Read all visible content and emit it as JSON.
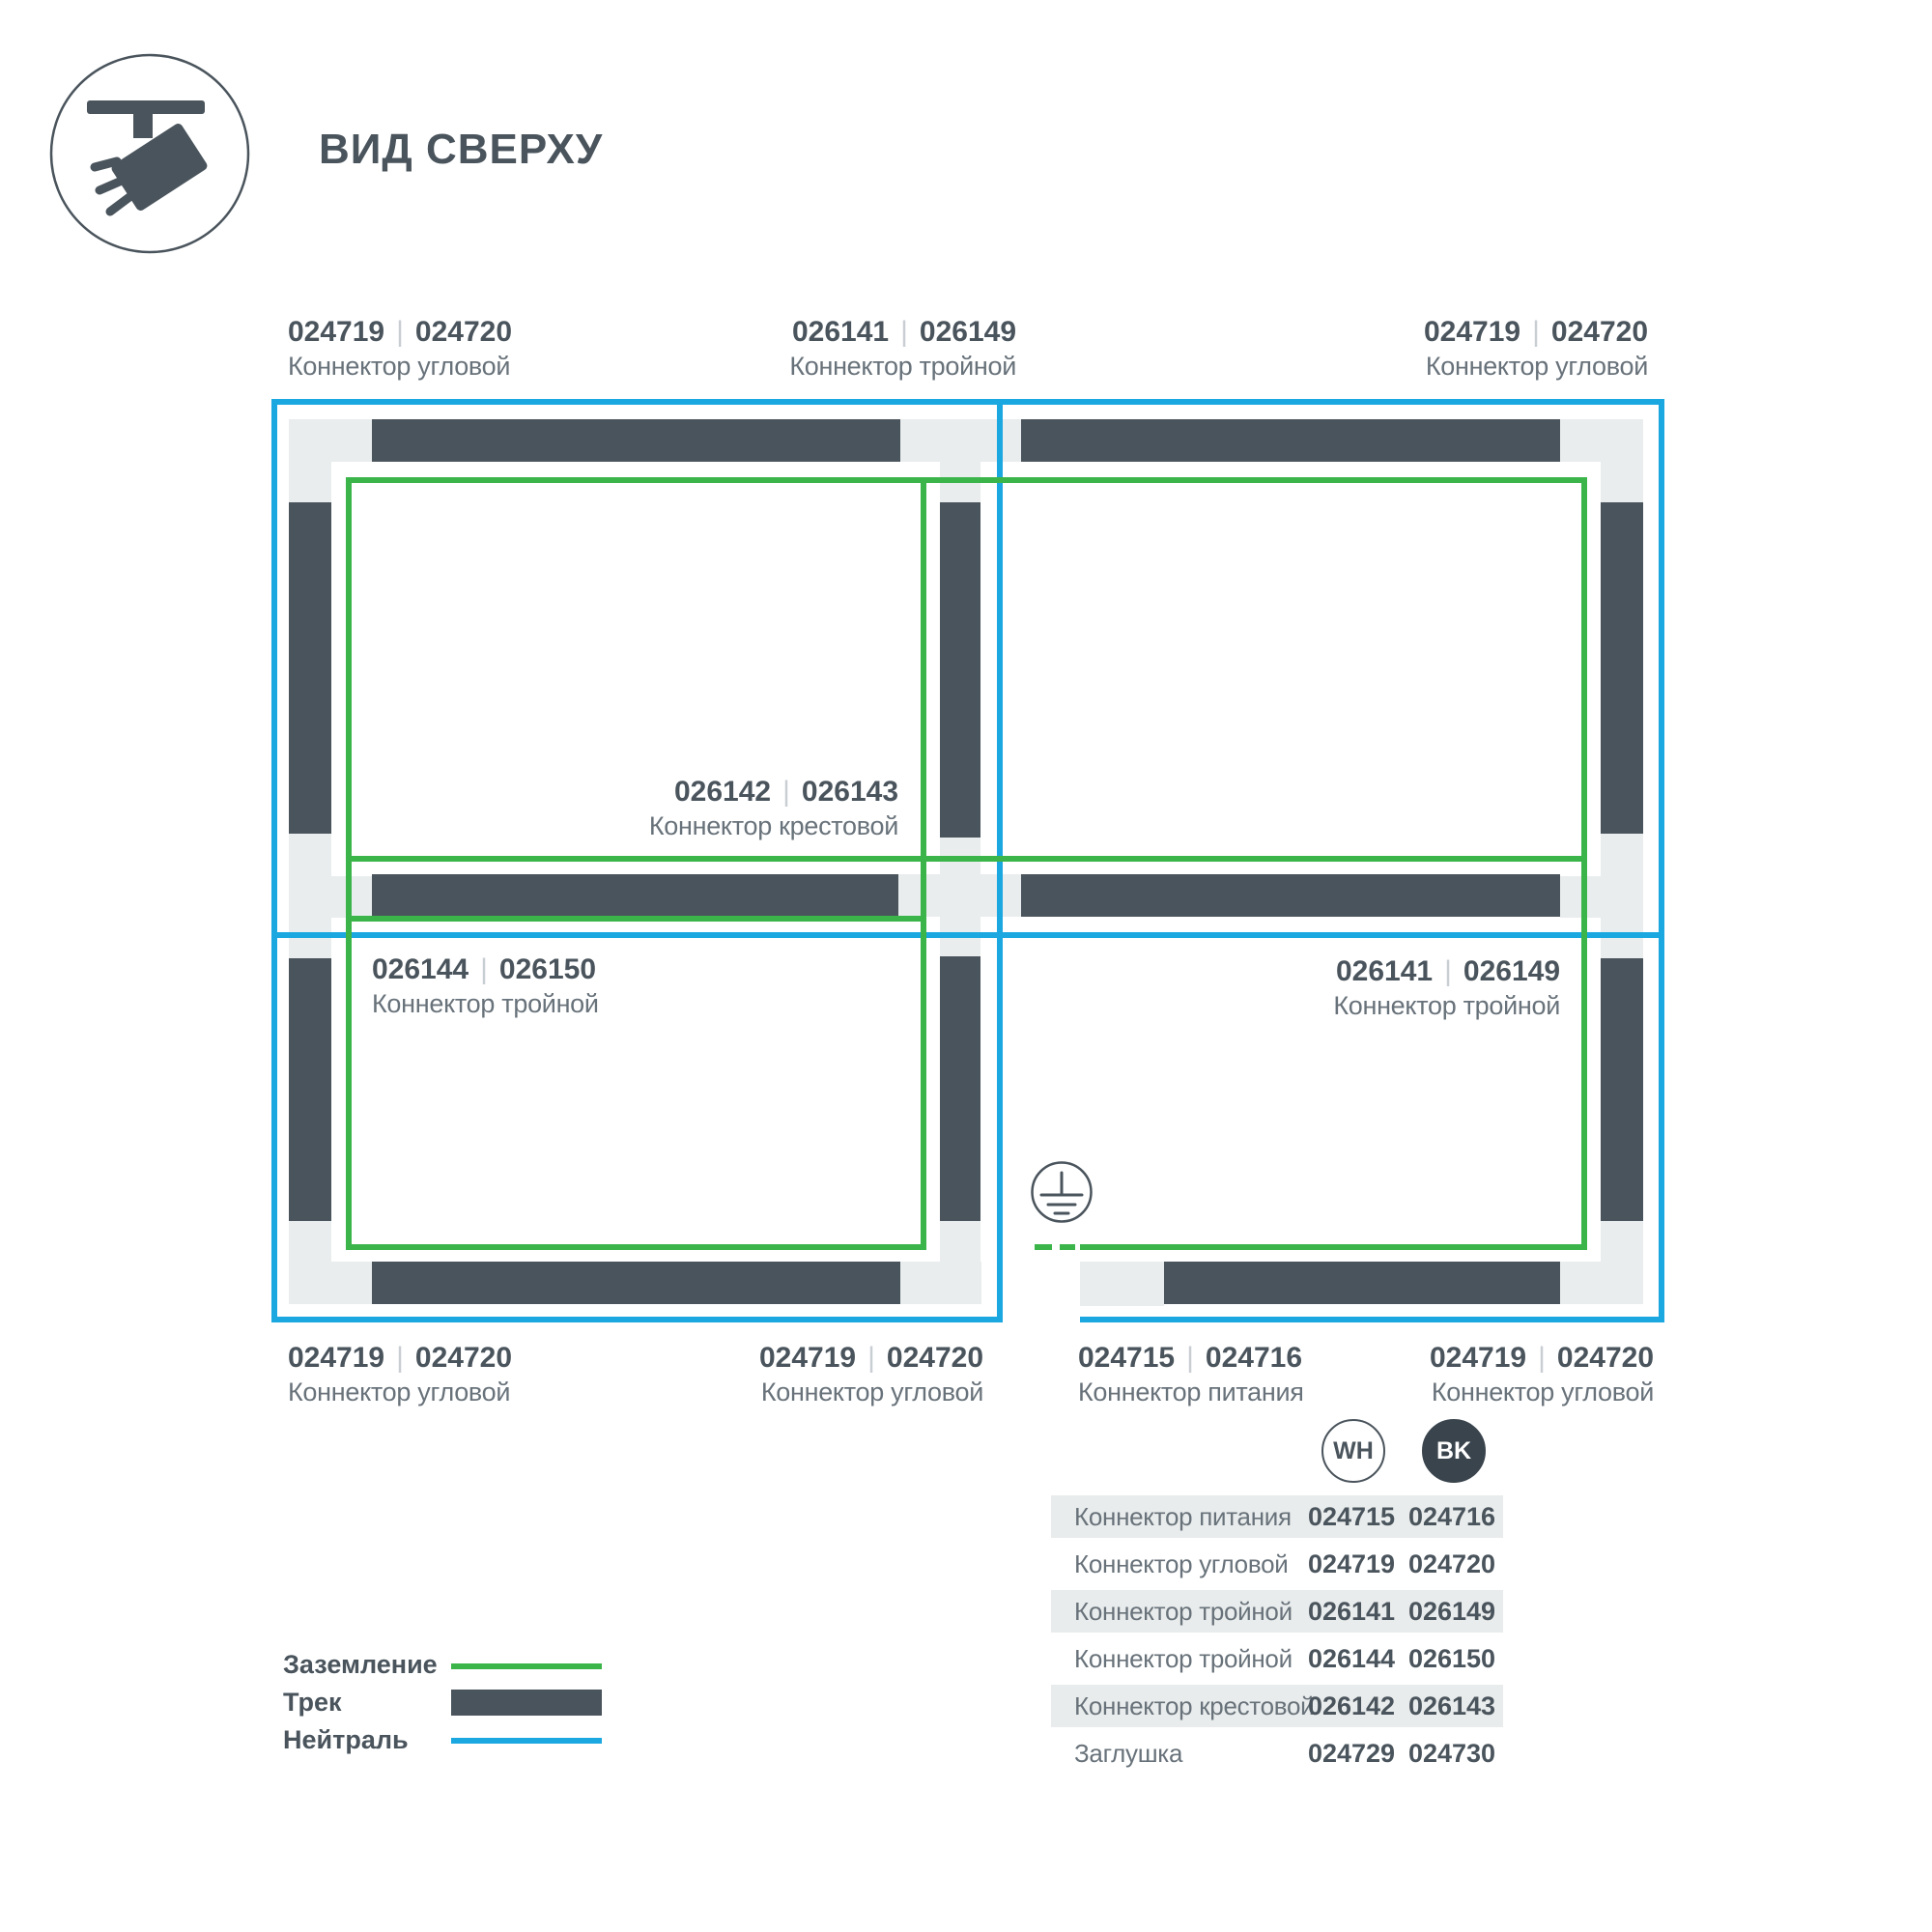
{
  "header": {
    "title": "ВИД СВЕРХУ",
    "icon": "track-spotlight-top-view-icon"
  },
  "ui": {
    "separator": "|"
  },
  "callouts": {
    "top_left": {
      "code_wh": "024719",
      "code_bk": "024720",
      "name": "Коннектор угловой"
    },
    "top_middle": {
      "code_wh": "026141",
      "code_bk": "026149",
      "name": "Коннектор тройной"
    },
    "top_right": {
      "code_wh": "024719",
      "code_bk": "024720",
      "name": "Коннектор угловой"
    },
    "cross": {
      "code_wh": "026142",
      "code_bk": "026143",
      "name": "Коннектор крестовой"
    },
    "mid_left": {
      "code_wh": "026144",
      "code_bk": "026150",
      "name": "Коннектор тройной"
    },
    "mid_right": {
      "code_wh": "026141",
      "code_bk": "026149",
      "name": "Коннектор тройной"
    },
    "bottom_1": {
      "code_wh": "024719",
      "code_bk": "024720",
      "name": "Коннектор угловой"
    },
    "bottom_2": {
      "code_wh": "024719",
      "code_bk": "024720",
      "name": "Коннектор угловой"
    },
    "bottom_3": {
      "code_wh": "024715",
      "code_bk": "024716",
      "name": "Коннектор питания"
    },
    "bottom_4": {
      "code_wh": "024719",
      "code_bk": "024720",
      "name": "Коннектор угловой"
    }
  },
  "legend": {
    "ground_label": "Заземление",
    "track_label": "Трек",
    "neutral_label": "Нейтраль"
  },
  "color_columns": {
    "wh": "WH",
    "bk": "BK"
  },
  "table": {
    "rows": [
      {
        "name": "Коннектор питания",
        "wh": "024715",
        "bk": "024716"
      },
      {
        "name": "Коннектор угловой",
        "wh": "024719",
        "bk": "024720"
      },
      {
        "name": "Коннектор тройной",
        "wh": "026141",
        "bk": "026149"
      },
      {
        "name": "Коннектор тройной",
        "wh": "026144",
        "bk": "026150"
      },
      {
        "name": "Коннектор крестовой",
        "wh": "026142",
        "bk": "026143"
      },
      {
        "name": "Заглушка",
        "wh": "024729",
        "bk": "024730"
      }
    ]
  },
  "colors": {
    "track": "#4a545c",
    "connector": "#e9eded",
    "ground": "#3bb54a",
    "neutral": "#1ba7e0",
    "text_dark": "#4a545c",
    "text_muted": "#68727a",
    "row_stripe": "#e9ecec",
    "bk_badge": "#3a444d"
  }
}
